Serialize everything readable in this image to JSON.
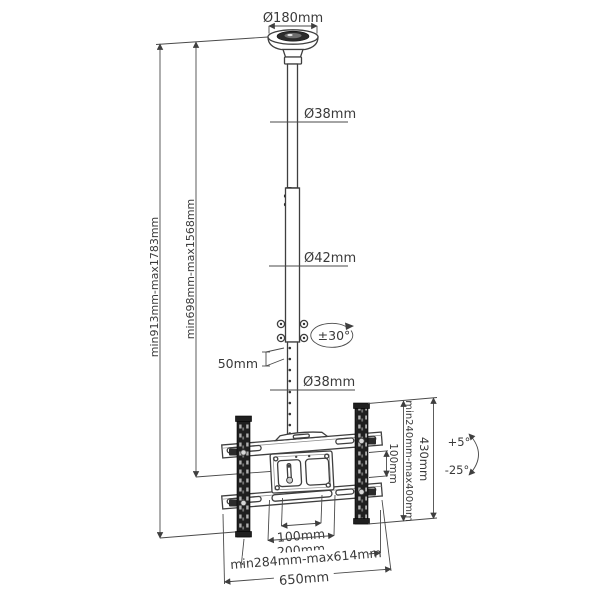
{
  "drawing_title": "ceiling-tv-mount-dimension-drawing",
  "labels": {
    "plate_diameter": "Ø180mm",
    "upper_pole_diameter": "Ø38mm",
    "middle_pole_diameter": "Ø42mm",
    "hole_spacing": "50mm",
    "swivel_range": "±30°",
    "lower_pole_diameter": "Ø38mm",
    "overall_height_range": "min913mm-max1783mm",
    "pole_height_range": "min698mm-max1568mm",
    "vesa_height_range": "min240mm-max400mm",
    "rail_length": "430mm",
    "crossbar_gap": "100mm",
    "tilt_up": "+5°",
    "tilt_down": "-25°",
    "vesa_width_100": "100mm",
    "vesa_width_200": "200mm",
    "arm_span_range": "min284mm-max614mm",
    "crossbar_length": "650mm"
  },
  "colors": {
    "background": "#ffffff",
    "line": "#3f3f3f",
    "rail_fill": "#1f1f1f",
    "text": "#3a3a3a"
  }
}
